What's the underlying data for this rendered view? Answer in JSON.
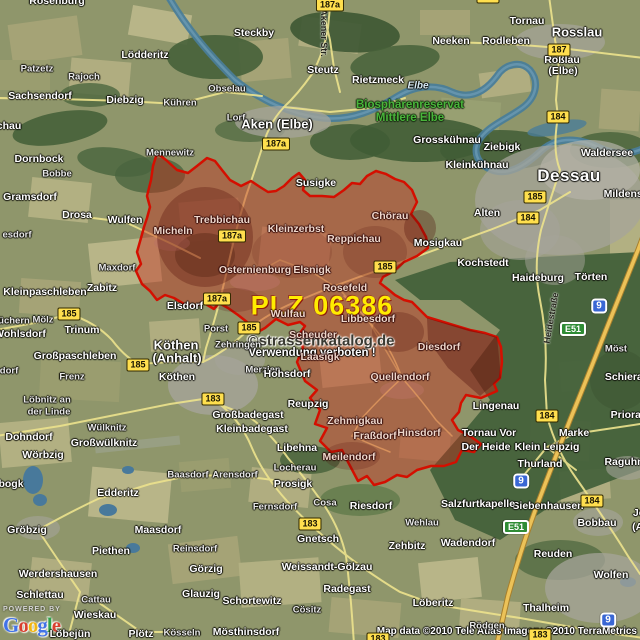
{
  "map": {
    "region": {
      "plz_label": "PLZ 06386",
      "border_color": "#d40f00",
      "fill_color": "rgba(198,40,26,0.42)"
    },
    "watermark": {
      "line1": "©strassenkatalog.de",
      "line2": "Verwendung verboten !"
    },
    "attribution": {
      "powered_by": "POWERED BY",
      "logo_letters": [
        {
          "ch": "G",
          "color": "#4273e8"
        },
        {
          "ch": "o",
          "color": "#d93f2e"
        },
        {
          "ch": "o",
          "color": "#f2b50f"
        },
        {
          "ch": "g",
          "color": "#4273e8"
        },
        {
          "ch": "l",
          "color": "#30a04a"
        },
        {
          "ch": "e",
          "color": "#d93f2e"
        }
      ],
      "copyright": "Map data ©2010 Tele Atlas  Imagery ©2010 TerraMetrics"
    },
    "street_labels": [
      {
        "t": "Akener Str.",
        "x": 324,
        "y": 33,
        "r": 90
      },
      {
        "t": "Heidestraße",
        "x": 551,
        "y": 318,
        "r": -80
      }
    ],
    "shields": [
      {
        "t": "187a",
        "x": 330,
        "y": 5,
        "k": "y"
      },
      {
        "t": "187a",
        "x": 276,
        "y": 144,
        "k": "y"
      },
      {
        "t": "187a",
        "x": 232,
        "y": 236,
        "k": "y"
      },
      {
        "t": "187a",
        "x": 217,
        "y": 299,
        "k": "y"
      },
      {
        "t": "187",
        "x": 559,
        "y": 50,
        "k": "y"
      },
      {
        "t": "187",
        "x": 488,
        "y": -3,
        "k": "y"
      },
      {
        "t": "184",
        "x": 558,
        "y": 117,
        "k": "y"
      },
      {
        "t": "184",
        "x": 528,
        "y": 218,
        "k": "y"
      },
      {
        "t": "184",
        "x": 547,
        "y": 416,
        "k": "y"
      },
      {
        "t": "184",
        "x": 592,
        "y": 501,
        "k": "y"
      },
      {
        "t": "185",
        "x": 535,
        "y": 197,
        "k": "y"
      },
      {
        "t": "185",
        "x": 69,
        "y": 314,
        "k": "y"
      },
      {
        "t": "185",
        "x": 138,
        "y": 365,
        "k": "y"
      },
      {
        "t": "185",
        "x": 249,
        "y": 328,
        "k": "y"
      },
      {
        "t": "185",
        "x": 385,
        "y": 267,
        "k": "y"
      },
      {
        "t": "183",
        "x": 213,
        "y": 399,
        "k": "y"
      },
      {
        "t": "183",
        "x": 310,
        "y": 524,
        "k": "y"
      },
      {
        "t": "183",
        "x": 540,
        "y": 635,
        "k": "y"
      },
      {
        "t": "183",
        "x": 378,
        "y": 639,
        "k": "y"
      },
      {
        "t": "9",
        "x": 599,
        "y": 306,
        "k": "a"
      },
      {
        "t": "9",
        "x": 521,
        "y": 481,
        "k": "a"
      },
      {
        "t": "9",
        "x": 608,
        "y": 620,
        "k": "a"
      },
      {
        "t": "E51",
        "x": 573,
        "y": 329,
        "k": "e"
      },
      {
        "t": "E51",
        "x": 516,
        "y": 527,
        "k": "e"
      }
    ],
    "towns": [
      {
        "t": "Rosenburg",
        "x": 57,
        "y": 1,
        "c": "n"
      },
      {
        "t": "chau",
        "x": 9,
        "y": 126,
        "c": "n"
      },
      {
        "t": "Lödderitz",
        "x": 145,
        "y": 55,
        "c": "n"
      },
      {
        "t": "Steckby",
        "x": 254,
        "y": 33,
        "c": "n"
      },
      {
        "t": "Steutz",
        "x": 323,
        "y": 70,
        "c": "n"
      },
      {
        "t": "Tornau",
        "x": 527,
        "y": 21,
        "c": "n"
      },
      {
        "t": "Rosslau",
        "x": 577,
        "y": 32,
        "c": "b"
      },
      {
        "t": "Rodleben",
        "x": 506,
        "y": 41,
        "c": "n"
      },
      {
        "t": "Neeken",
        "x": 451,
        "y": 41,
        "c": "n"
      },
      {
        "t": "Roßlau",
        "x": 562,
        "y": 60,
        "c": "n"
      },
      {
        "t": "(Elbe)",
        "x": 563,
        "y": 71,
        "c": "n"
      },
      {
        "t": "Patzetz",
        "x": 37,
        "y": 69,
        "c": "s"
      },
      {
        "t": "Rajoch",
        "x": 84,
        "y": 77,
        "c": "s"
      },
      {
        "t": "Sachsendorf",
        "x": 40,
        "y": 96,
        "c": "n"
      },
      {
        "t": "Diebzig",
        "x": 125,
        "y": 100,
        "c": "n"
      },
      {
        "t": "Kühren",
        "x": 180,
        "y": 103,
        "c": "s"
      },
      {
        "t": "Obselau",
        "x": 227,
        "y": 89,
        "c": "s"
      },
      {
        "t": "Lorf",
        "x": 236,
        "y": 118,
        "c": "s"
      },
      {
        "t": "Aken (Elbe)",
        "x": 277,
        "y": 124,
        "c": "b"
      },
      {
        "t": "Rietzmeck",
        "x": 378,
        "y": 80,
        "c": "n"
      },
      {
        "t": "Elbe",
        "x": 418,
        "y": 86,
        "c": "r"
      },
      {
        "t": "Biosphärenreservat",
        "x": 410,
        "y": 105,
        "c": "g"
      },
      {
        "t": "Mittlere Elbe",
        "x": 410,
        "y": 118,
        "c": "g"
      },
      {
        "t": "Grosskühnau",
        "x": 447,
        "y": 140,
        "c": "n"
      },
      {
        "t": "Ziebigk",
        "x": 502,
        "y": 147,
        "c": "n"
      },
      {
        "t": "Kleinkühnau",
        "x": 477,
        "y": 165,
        "c": "n"
      },
      {
        "t": "Waldersee",
        "x": 607,
        "y": 153,
        "c": "n"
      },
      {
        "t": "Dessau",
        "x": 569,
        "y": 176,
        "c": "c"
      },
      {
        "t": "Mildensee",
        "x": 629,
        "y": 194,
        "c": "n"
      },
      {
        "t": "Alten",
        "x": 487,
        "y": 213,
        "c": "n"
      },
      {
        "t": "Mosigkau",
        "x": 438,
        "y": 243,
        "c": "n"
      },
      {
        "t": "Kochstedt",
        "x": 483,
        "y": 263,
        "c": "n"
      },
      {
        "t": "Haideburg",
        "x": 538,
        "y": 278,
        "c": "n"
      },
      {
        "t": "Törten",
        "x": 591,
        "y": 277,
        "c": "n"
      },
      {
        "t": "Möst",
        "x": 616,
        "y": 349,
        "c": "s"
      },
      {
        "t": "Schierau",
        "x": 627,
        "y": 377,
        "c": "n"
      },
      {
        "t": "Priorau",
        "x": 629,
        "y": 415,
        "c": "n"
      },
      {
        "t": "Lingenau",
        "x": 496,
        "y": 406,
        "c": "n"
      },
      {
        "t": "Marke",
        "x": 574,
        "y": 433,
        "c": "n"
      },
      {
        "t": "Klein Leipzig",
        "x": 547,
        "y": 447,
        "c": "n"
      },
      {
        "t": "Tornau Vor",
        "x": 489,
        "y": 433,
        "c": "n"
      },
      {
        "t": "Der Heide",
        "x": 486,
        "y": 447,
        "c": "n"
      },
      {
        "t": "Thurland",
        "x": 540,
        "y": 464,
        "c": "n"
      },
      {
        "t": "Raguhn",
        "x": 624,
        "y": 462,
        "c": "n"
      },
      {
        "t": "Siebenhausen",
        "x": 548,
        "y": 506,
        "c": "n"
      },
      {
        "t": "Salzfurtkapelle",
        "x": 478,
        "y": 504,
        "c": "n"
      },
      {
        "t": "Bobbau",
        "x": 597,
        "y": 523,
        "c": "n"
      },
      {
        "t": "Jeßnitz",
        "x": 651,
        "y": 513,
        "c": "n"
      },
      {
        "t": "(Anhalt)",
        "x": 652,
        "y": 527,
        "c": "n"
      },
      {
        "t": "Reuden",
        "x": 553,
        "y": 554,
        "c": "n"
      },
      {
        "t": "Wolfen",
        "x": 611,
        "y": 575,
        "c": "n"
      },
      {
        "t": "Thalheim",
        "x": 546,
        "y": 608,
        "c": "n"
      },
      {
        "t": "Rödgen",
        "x": 487,
        "y": 626,
        "c": "s"
      },
      {
        "t": "Löberitz",
        "x": 433,
        "y": 603,
        "c": "n"
      },
      {
        "t": "Zehbitz",
        "x": 407,
        "y": 546,
        "c": "n"
      },
      {
        "t": "Wadendorf",
        "x": 468,
        "y": 543,
        "c": "n"
      },
      {
        "t": "Wehlau",
        "x": 422,
        "y": 523,
        "c": "s"
      },
      {
        "t": "Riesdorf",
        "x": 371,
        "y": 506,
        "c": "n"
      },
      {
        "t": "Cosa",
        "x": 325,
        "y": 503,
        "c": "s"
      },
      {
        "t": "Gnetsch",
        "x": 318,
        "y": 539,
        "c": "n"
      },
      {
        "t": "Weissandt-Gölzau",
        "x": 327,
        "y": 567,
        "c": "n"
      },
      {
        "t": "Radegast",
        "x": 347,
        "y": 589,
        "c": "n"
      },
      {
        "t": "Cösitz",
        "x": 307,
        "y": 610,
        "c": "s"
      },
      {
        "t": "Schortewitz",
        "x": 252,
        "y": 601,
        "c": "n"
      },
      {
        "t": "Mösthinsdorf",
        "x": 246,
        "y": 632,
        "c": "n"
      },
      {
        "t": "Löbejün",
        "x": 70,
        "y": 634,
        "c": "n"
      },
      {
        "t": "Plötz",
        "x": 141,
        "y": 634,
        "c": "n"
      },
      {
        "t": "Kösseln",
        "x": 182,
        "y": 633,
        "c": "s"
      },
      {
        "t": "Wieskau",
        "x": 95,
        "y": 615,
        "c": "n"
      },
      {
        "t": "Cattau",
        "x": 96,
        "y": 600,
        "c": "s"
      },
      {
        "t": "Schlettau",
        "x": 40,
        "y": 595,
        "c": "n"
      },
      {
        "t": "Werdershausen",
        "x": 58,
        "y": 574,
        "c": "n"
      },
      {
        "t": "Gröbzig",
        "x": 27,
        "y": 530,
        "c": "n"
      },
      {
        "t": "bogk",
        "x": 11,
        "y": 484,
        "c": "n"
      },
      {
        "t": "Edderitz",
        "x": 118,
        "y": 493,
        "c": "n"
      },
      {
        "t": "Maasdorf",
        "x": 158,
        "y": 530,
        "c": "n"
      },
      {
        "t": "Piethen",
        "x": 111,
        "y": 551,
        "c": "n"
      },
      {
        "t": "Reinsdorf",
        "x": 195,
        "y": 549,
        "c": "s"
      },
      {
        "t": "Görzig",
        "x": 206,
        "y": 569,
        "c": "n"
      },
      {
        "t": "Glauzig",
        "x": 201,
        "y": 594,
        "c": "n"
      },
      {
        "t": "Baasdorf",
        "x": 188,
        "y": 475,
        "c": "s"
      },
      {
        "t": "Arensdorf",
        "x": 235,
        "y": 475,
        "c": "s"
      },
      {
        "t": "Prosigk",
        "x": 293,
        "y": 484,
        "c": "n"
      },
      {
        "t": "Fernsdorf",
        "x": 275,
        "y": 507,
        "c": "s"
      },
      {
        "t": "Libehna",
        "x": 297,
        "y": 448,
        "c": "n"
      },
      {
        "t": "Locherau",
        "x": 295,
        "y": 468,
        "c": "s"
      },
      {
        "t": "Meilendorf",
        "x": 349,
        "y": 457,
        "c": "d"
      },
      {
        "t": "Wörbzig",
        "x": 43,
        "y": 455,
        "c": "n"
      },
      {
        "t": "Dohndorf",
        "x": 29,
        "y": 437,
        "c": "n"
      },
      {
        "t": "Wülknitz",
        "x": 107,
        "y": 428,
        "c": "s"
      },
      {
        "t": "Großwülknitz",
        "x": 104,
        "y": 443,
        "c": "n"
      },
      {
        "t": "Löbnitz an",
        "x": 47,
        "y": 400,
        "c": "s"
      },
      {
        "t": "der Linde",
        "x": 49,
        "y": 412,
        "c": "s"
      },
      {
        "t": "Frenz",
        "x": 72,
        "y": 377,
        "c": "s"
      },
      {
        "t": "Großpaschleben",
        "x": 75,
        "y": 356,
        "c": "n"
      },
      {
        "t": "Köthen",
        "x": 176,
        "y": 345,
        "c": "b"
      },
      {
        "t": "(Anhalt)",
        "x": 177,
        "y": 358,
        "c": "b"
      },
      {
        "t": "Köthen",
        "x": 177,
        "y": 377,
        "c": "n"
      },
      {
        "t": "üchern",
        "x": 14,
        "y": 321,
        "c": "s"
      },
      {
        "t": "Mölz",
        "x": 43,
        "y": 320,
        "c": "s"
      },
      {
        "t": "Wohlsdorf",
        "x": 20,
        "y": 334,
        "c": "n"
      },
      {
        "t": "Trinum",
        "x": 82,
        "y": 330,
        "c": "n"
      },
      {
        "t": "dorf",
        "x": 9,
        "y": 371,
        "c": "s"
      },
      {
        "t": "esdorf",
        "x": 17,
        "y": 235,
        "c": "s"
      },
      {
        "t": "Kleinpaschleben",
        "x": 45,
        "y": 292,
        "c": "n"
      },
      {
        "t": "Zabitz",
        "x": 102,
        "y": 288,
        "c": "n"
      },
      {
        "t": "Maxdorf",
        "x": 117,
        "y": 268,
        "c": "s"
      },
      {
        "t": "Elsdorf",
        "x": 185,
        "y": 306,
        "c": "n"
      },
      {
        "t": "Porst",
        "x": 216,
        "y": 329,
        "c": "s"
      },
      {
        "t": "Zehringen",
        "x": 238,
        "y": 345,
        "c": "s"
      },
      {
        "t": "Merzien",
        "x": 263,
        "y": 370,
        "c": "s"
      },
      {
        "t": "Hohsdorf",
        "x": 287,
        "y": 374,
        "c": "n"
      },
      {
        "t": "Reupzig",
        "x": 308,
        "y": 404,
        "c": "n"
      },
      {
        "t": "Großbadegast",
        "x": 248,
        "y": 415,
        "c": "n"
      },
      {
        "t": "Kleinbadegast",
        "x": 252,
        "y": 429,
        "c": "n"
      },
      {
        "t": "Dornbock",
        "x": 39,
        "y": 159,
        "c": "n"
      },
      {
        "t": "Bobbe",
        "x": 57,
        "y": 174,
        "c": "s"
      },
      {
        "t": "Gramsdorf",
        "x": 30,
        "y": 197,
        "c": "n"
      },
      {
        "t": "Drosa",
        "x": 77,
        "y": 215,
        "c": "n"
      },
      {
        "t": "Wulfen",
        "x": 125,
        "y": 220,
        "c": "n"
      },
      {
        "t": "Mennewitz",
        "x": 170,
        "y": 153,
        "c": "s"
      },
      {
        "t": "Susigke",
        "x": 316,
        "y": 183,
        "c": "n"
      },
      {
        "t": "Micheln",
        "x": 173,
        "y": 231,
        "c": "d"
      },
      {
        "t": "Trebbichau",
        "x": 222,
        "y": 220,
        "c": "d"
      },
      {
        "t": "Kleinzerbst",
        "x": 296,
        "y": 229,
        "c": "d"
      },
      {
        "t": "Reppichau",
        "x": 354,
        "y": 239,
        "c": "d"
      },
      {
        "t": "Chörau",
        "x": 390,
        "y": 216,
        "c": "d"
      },
      {
        "t": "Osternienburg",
        "x": 255,
        "y": 270,
        "c": "d"
      },
      {
        "t": "Elsnigk",
        "x": 312,
        "y": 270,
        "c": "d"
      },
      {
        "t": "Rosefeld",
        "x": 345,
        "y": 288,
        "c": "d"
      },
      {
        "t": "Wulfau",
        "x": 288,
        "y": 314,
        "c": "d"
      },
      {
        "t": "Scheuder",
        "x": 313,
        "y": 335,
        "c": "d"
      },
      {
        "t": "Laasigk",
        "x": 320,
        "y": 357,
        "c": "d"
      },
      {
        "t": "Libbesdorf",
        "x": 368,
        "y": 319,
        "c": "d"
      },
      {
        "t": "Quellendorf",
        "x": 400,
        "y": 377,
        "c": "d"
      },
      {
        "t": "Diesdorf",
        "x": 439,
        "y": 347,
        "c": "d"
      },
      {
        "t": "Zehmigkau",
        "x": 355,
        "y": 421,
        "c": "d"
      },
      {
        "t": "Fraßdorf",
        "x": 375,
        "y": 436,
        "c": "d"
      },
      {
        "t": "Hinsdorf",
        "x": 419,
        "y": 433,
        "c": "d"
      }
    ]
  }
}
